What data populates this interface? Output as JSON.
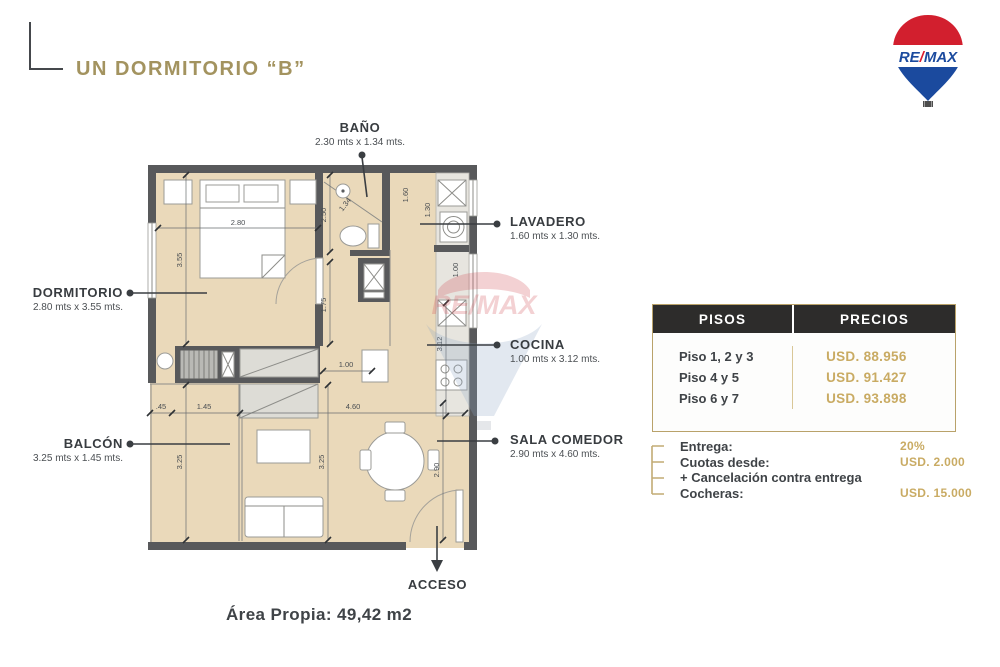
{
  "title": "UN DORMITORIO “B”",
  "logo": {
    "brand_re": "RE",
    "brand_slash": "/",
    "brand_max": "MAX"
  },
  "watermark": {
    "brand": "RE/MAX"
  },
  "floorplan": {
    "rooms": [
      {
        "name": "BAÑO",
        "dims": "2.30 mts x 1.34 mts."
      },
      {
        "name": "LAVADERO",
        "dims": "1.60 mts x 1.30 mts."
      },
      {
        "name": "DORMITORIO",
        "dims": "2.80 mts x 3.55 mts."
      },
      {
        "name": "COCINA",
        "dims": "1.00 mts x 3.12 mts."
      },
      {
        "name": "BALCÓN",
        "dims": "3.25 mts x 1.45 mts."
      },
      {
        "name": "SALA COMEDOR",
        "dims": "2.90 mts x 4.60 mts."
      },
      {
        "name": "ACCESO",
        "dims": ""
      }
    ],
    "dims": [
      "2.80",
      "3.55",
      "2.50",
      "1.34",
      "1.75",
      "1.60",
      "1.30",
      "1.00",
      "3.12",
      "1.00",
      ".45",
      "1.45",
      "3.25",
      "3.25",
      "4.60",
      "2.90"
    ],
    "area_label": "Área Propia: 49,42 m2"
  },
  "pricing_table": {
    "headers": [
      "PISOS",
      "PRECIOS"
    ],
    "rows": [
      {
        "floor": "Piso 1, 2 y 3",
        "price": "USD. 88.956"
      },
      {
        "floor": "Piso 4 y 5",
        "price": "USD. 91.427"
      },
      {
        "floor": "Piso 6 y 7",
        "price": "USD. 93.898"
      }
    ]
  },
  "payment": {
    "items": [
      {
        "label": "Entrega:",
        "value": "20%"
      },
      {
        "label": "Cuotas desde:",
        "value": "USD. 2.000"
      },
      {
        "label": "+ Cancelación contra entrega",
        "value": ""
      },
      {
        "label": "Cocheras:",
        "value": "USD. 15.000"
      }
    ]
  },
  "colors": {
    "gold": "#a3935f",
    "price-gold": "#c9ab63",
    "dark": "#3f4347",
    "wall": "#58595b",
    "floor": "#ead9ba",
    "remax-red": "#dc1c2e",
    "remax-blue": "#1b4a9e"
  }
}
